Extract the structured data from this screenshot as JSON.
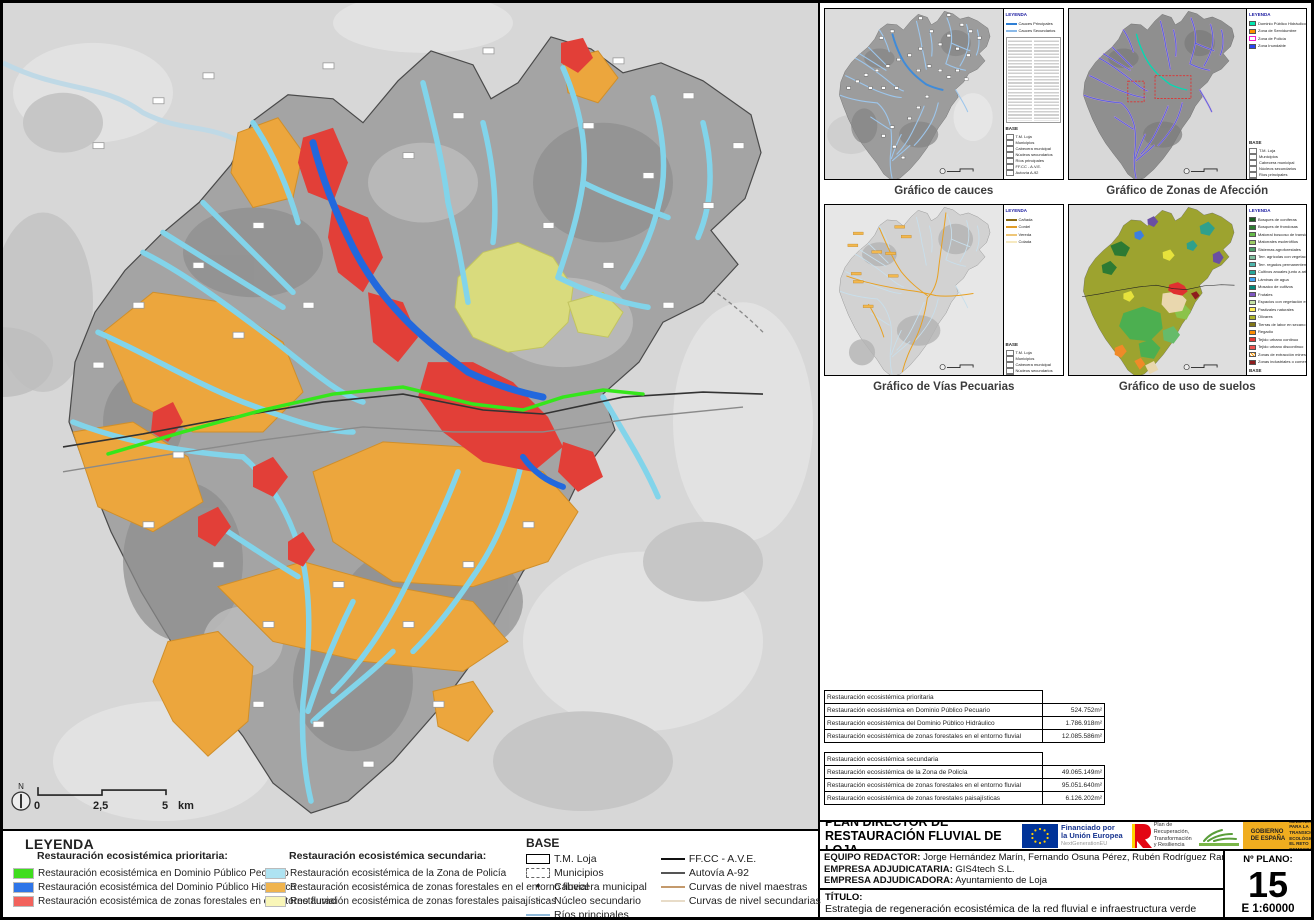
{
  "main_legend": {
    "title": "LEYENDA",
    "priority_subtitle": "Restauración ecosistémica prioritaria:",
    "priority_items": [
      {
        "label": "Restauración ecosistémica en Dominio Público Pecuario",
        "color": "#3fdd1e"
      },
      {
        "label": "Restauración ecosistémica del Dominio Público Hidráulico",
        "color": "#2e75e8"
      },
      {
        "label": "Restauración ecosistémica de zonas forestales en el entorno fluvial",
        "color": "#f2625c"
      }
    ],
    "secondary_subtitle": "Restauración ecosistémica secundaria:",
    "secondary_items": [
      {
        "label": "Restauración ecosistémica de la Zona de Policía",
        "color": "#aee3f2"
      },
      {
        "label": "Restauración ecosistémica de zonas forestales en el entorno fluvial",
        "color": "#f0b44e"
      },
      {
        "label": "Restauración ecosistémica de zonas forestales paisajísticas",
        "color": "#f9f6b8"
      }
    ]
  },
  "base_legend": {
    "title": "BASE",
    "col1": [
      {
        "label": "T.M. Loja",
        "kind": "ic-rect"
      },
      {
        "label": "Municipios",
        "kind": "ic-rect-d"
      },
      {
        "label": "Cabecera municipal",
        "kind": "ic-dot"
      },
      {
        "label": "Núcleo secundario",
        "kind": "ic-dot-sm"
      },
      {
        "label": "Ríos principales",
        "kind": "ic-line",
        "color": "#8fb9d9"
      }
    ],
    "col2": [
      {
        "label": "FF.CC - A.V.E.",
        "kind": "ic-line",
        "color": "#111111"
      },
      {
        "label": "Autovía A-92",
        "kind": "ic-line",
        "color": "#555555"
      },
      {
        "label": "Curvas de nivel maestras",
        "kind": "ic-line",
        "color": "#c49a6c"
      },
      {
        "label": "Curvas de nivel secundarias",
        "kind": "ic-line",
        "color": "#e8dcc8"
      }
    ]
  },
  "main_map": {
    "north_label": "N",
    "scale": {
      "zero": "0",
      "mid": "2,5",
      "max": "5",
      "unit": "km"
    }
  },
  "minimaps": {
    "cauces": {
      "caption": "Gráfico de cauces",
      "legend_title": "LEYENDA",
      "entries": [
        {
          "label": "Cauces Principales",
          "kind": "k-line",
          "color": "#2f7fd4"
        },
        {
          "label": "Cauces Secundarios",
          "kind": "k-line",
          "color": "#8ab9e8"
        }
      ],
      "base_title": "BASE",
      "base_items": [
        "T.M. Loja",
        "Municipios",
        "Cabecera municipal",
        "Núcleos secundarios",
        "Ríos principales",
        "FF.CC - A.V.E.",
        "Autovía A-92"
      ]
    },
    "afeccion": {
      "caption": "Gráfico de Zonas de Afección",
      "legend_title": "LEYENDA",
      "entries": [
        {
          "label": "Dominio Público Hidráulico",
          "kind": "k-chip",
          "color": "#00e6b0"
        },
        {
          "label": "Zona de Servidumbre",
          "kind": "k-chip",
          "color": "#ff9100"
        },
        {
          "label": "Zona de Policía",
          "kind": "k-chip-o",
          "color": "#f020d0"
        },
        {
          "label": "Zona Inundable",
          "kind": "k-chip",
          "color": "#2945f0"
        }
      ],
      "base_title": "BASE",
      "base_items": [
        "T.M. Loja",
        "Municipios",
        "Cabecera municipal",
        "Núcleos secundarios",
        "Ríos principales",
        "FF.CC - A.V.E.",
        "Autovía A-92",
        "Hoja de detalle"
      ]
    },
    "pecuarias": {
      "caption": "Gráfico de Vías Pecuarias",
      "legend_title": "LEYENDA",
      "entries": [
        {
          "label": "Cañada",
          "kind": "k-line",
          "color": "#8a6a14"
        },
        {
          "label": "Cordel",
          "kind": "k-line",
          "color": "#e09c28"
        },
        {
          "label": "Vereda",
          "kind": "k-line",
          "color": "#eec678"
        },
        {
          "label": "Colada",
          "kind": "k-line",
          "color": "#f6e9c0"
        }
      ],
      "base_title": "BASE",
      "base_items": [
        "T.M. Loja",
        "Municipios",
        "Cabecera municipal",
        "Núcleos secundarios",
        "Ríos principales",
        "FF.CC - A.V.E.",
        "Autovía A-92"
      ]
    },
    "suelos": {
      "caption": "Gráfico de uso de suelos",
      "legend_title": "LEYENDA",
      "entries": [
        {
          "label": "Bosques de coníferas",
          "kind": "k-chip",
          "color": "#1b5e20"
        },
        {
          "label": "Bosques de frondosas",
          "kind": "k-chip",
          "color": "#2e7d32"
        },
        {
          "label": "Matorral boscoso de transición",
          "kind": "k-chip",
          "color": "#66bb4a"
        },
        {
          "label": "Matorrales esclerófilos",
          "kind": "k-chip",
          "color": "#9ccc65"
        },
        {
          "label": "Sistemas agroforestales",
          "kind": "k-chip",
          "color": "#4d9e6a"
        },
        {
          "label": "Terr. agrícolas con vegetación natural",
          "kind": "k-chip",
          "color": "#7fbf9f"
        },
        {
          "label": "Terr. regados permanentemente",
          "kind": "k-chip",
          "color": "#4db6ac"
        },
        {
          "label": "Cultivos anuales junto a arbolado",
          "kind": "k-chip",
          "color": "#26a69a"
        },
        {
          "label": "Láminas de agua",
          "kind": "k-chip",
          "color": "#42a5f5"
        },
        {
          "label": "Mosaico de cultivos",
          "kind": "k-chip",
          "color": "#00897b"
        },
        {
          "label": "Frutales",
          "kind": "k-chip",
          "color": "#7e57c2"
        },
        {
          "label": "Espacios con vegetación escasa",
          "kind": "k-chip",
          "color": "#c5e1a5"
        },
        {
          "label": "Pastizales naturales",
          "kind": "k-chip",
          "color": "#ffee58"
        },
        {
          "label": "Olivares",
          "kind": "k-chip",
          "color": "#afb42b"
        },
        {
          "label": "Tierras de labor en secano",
          "kind": "k-chip",
          "color": "#827717"
        },
        {
          "label": "Regadío",
          "kind": "k-chip",
          "color": "#fb8c00"
        },
        {
          "label": "Tejido urbano continuo",
          "kind": "k-chip",
          "color": "#e53935"
        },
        {
          "label": "Tejido urbano discontinuo",
          "kind": "k-chip",
          "color": "#ef5350"
        },
        {
          "label": "Zonas de extracción minera",
          "kind": "k-chip-h",
          "color": "#ff9800"
        },
        {
          "label": "Zonas industriales o comerciales",
          "kind": "k-chip",
          "color": "#8e1d1d"
        }
      ],
      "base_title": "BASE",
      "base_items": [
        "T.M. Loja",
        "Municipios",
        "Cabecera municipal",
        "Núcleos secundarios",
        "Ríos principales",
        "FF.CC - A.V.E.",
        "Autovía A-92"
      ]
    }
  },
  "tables": {
    "t1": {
      "header": "Restauración ecosistémica prioritaria",
      "rows": [
        {
          "label": "Restauración ecosistémica en Dominio Público Pecuario",
          "value": "524.752m²"
        },
        {
          "label": "Restauración ecosistémica del Dominio Público Hidráulico",
          "value": "1.786.918m²"
        },
        {
          "label": "Restauración ecosistémica de zonas forestales en el entorno fluvial",
          "value": "12.085.586m²"
        }
      ]
    },
    "t2": {
      "header": "Restauración ecosistémica secundaria",
      "rows": [
        {
          "label": "Restauración ecosistémica de la Zona de Policía",
          "value": "49.065.149m²"
        },
        {
          "label": "Restauración ecosistémica de zonas forestales en el entorno fluvial",
          "value": "95.051.640m²"
        },
        {
          "label": "Restauración ecosistémica de zonas forestales paisajísticas",
          "value": "6.126.202m²"
        }
      ]
    }
  },
  "titleblock": {
    "project_line1": "PLAN DIRECTOR DE",
    "project_line2": "RESTAURACIÓN FLUVIAL DE LOJA",
    "eu_l1": "Financiado por",
    "eu_l2": "la Unión Europea",
    "eu_sub": "NextGenerationEU",
    "prtr_l1": "Plan de",
    "prtr_l2": "Recuperación,",
    "prtr_l3": "Transformación",
    "prtr_l4": "y Resiliencia",
    "gob_l1": "GOBIERNO",
    "gob_l2": "DE ESPAÑA",
    "ministerio": "MINISTERIO PARA LA TRANSICIÓN ECOLÓGICA Y EL RETO DEMOGRÁFICO",
    "equipo_label": "EQUIPO REDACTOR:",
    "equipo": "Jorge Hernández Marín, Fernando Osuna Pérez, Rubén Rodríguez Ramírez",
    "adjudicataria_label": "EMPRESA ADJUDICATARIA:",
    "adjudicataria": "GIS4tech S.L.",
    "adjudicadora_label": "EMPRESA ADJUDICADORA:",
    "adjudicadora": "Ayuntamiento de Loja",
    "ayto_l1": "AYUNTAMIENTO",
    "ayto_l2": "DE LOJA",
    "paseo_l1": "Paseo",
    "paseo_l1b": "del",
    "paseo_l2": "Genil",
    "nplano_label": "Nº PLANO:",
    "nplano": "15",
    "escala": "E 1:60000",
    "titulo_label": "TÍTULO:",
    "titulo": "Estrategia de regeneración ecosistémica de la red fluvial e infraestructura verde"
  }
}
